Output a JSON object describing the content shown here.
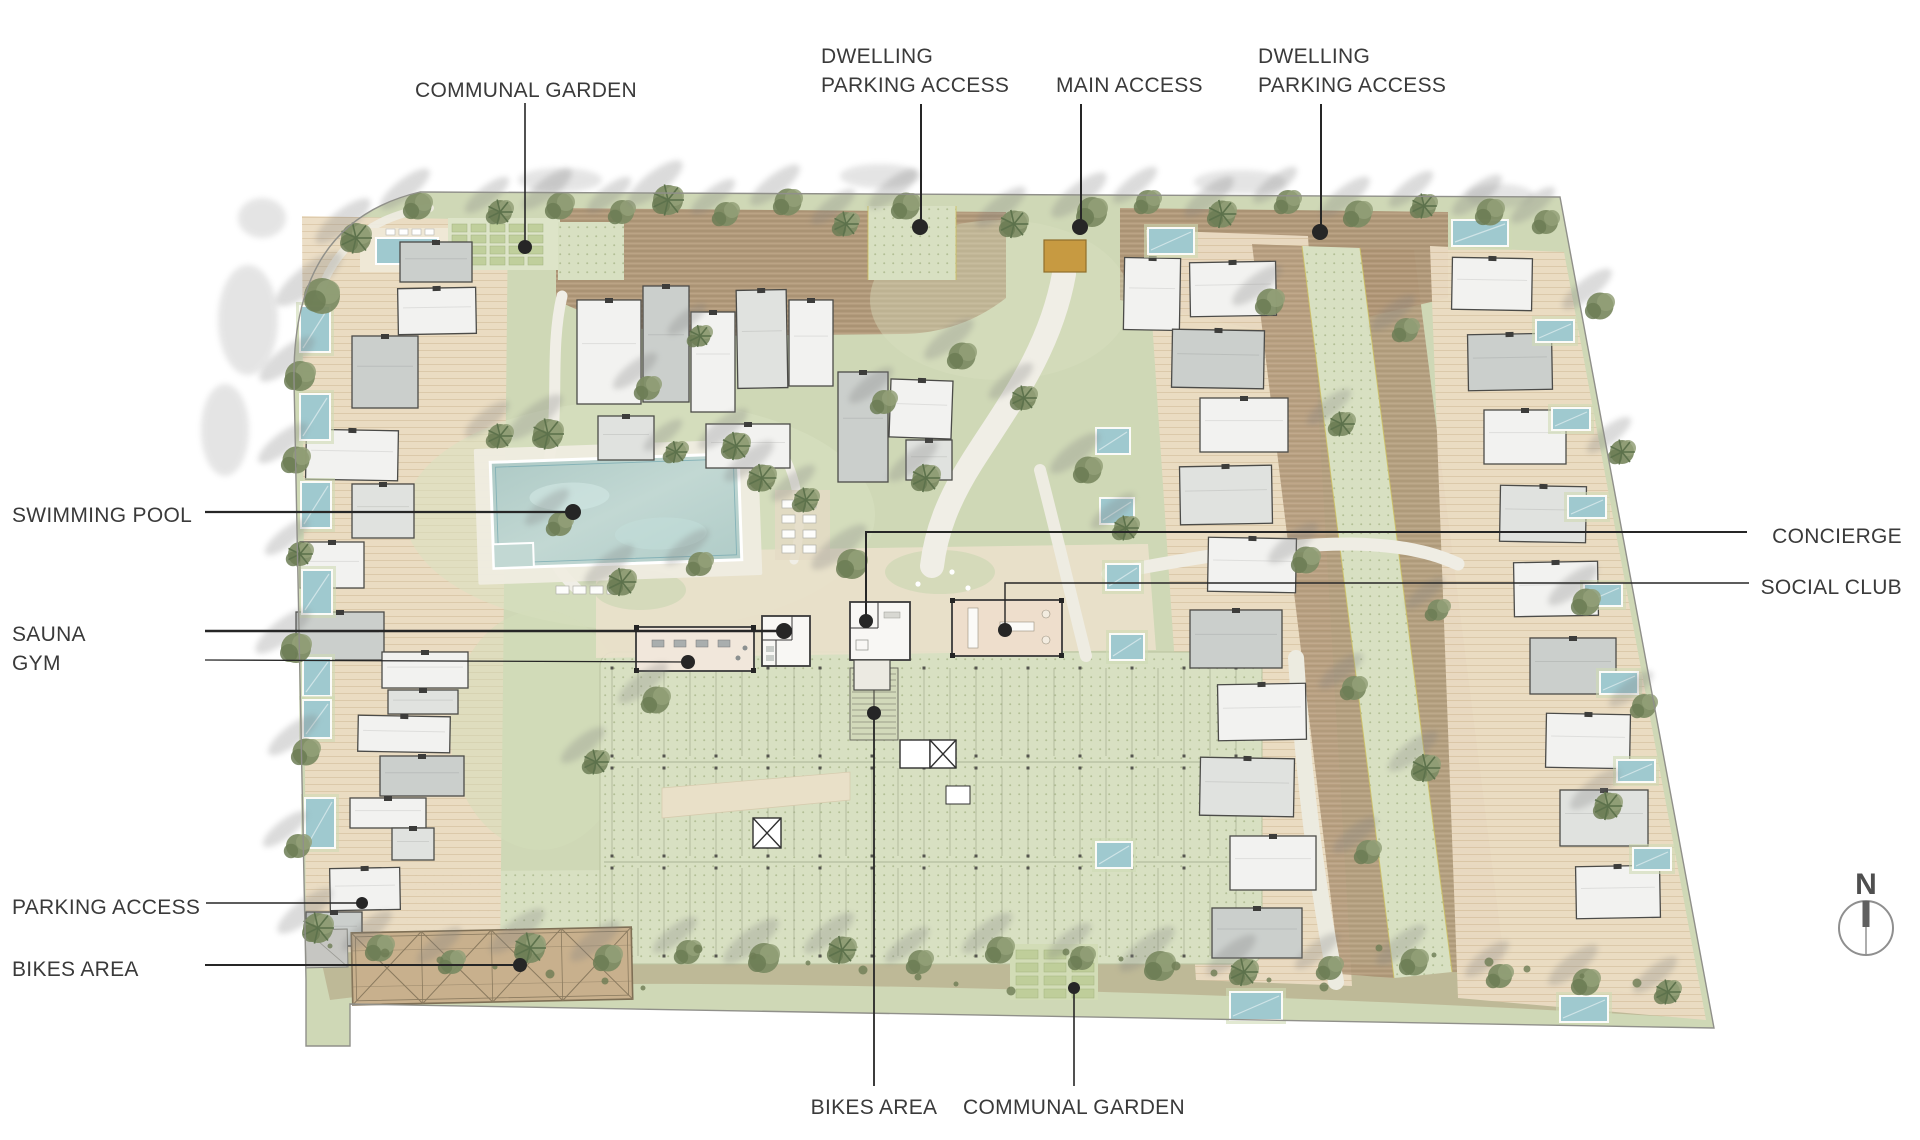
{
  "page": {
    "background": "#ffffff"
  },
  "compass": {
    "letter": "N"
  },
  "palette": {
    "label_ink": "#3a3a3a",
    "leader_ink": "#262626",
    "site_ground": "#cfd8b6",
    "paving_dotted": "#d8e0c2",
    "terrace": "#ebdcc3",
    "deck_brown": "#b2987a",
    "path": "#f0eee6",
    "plaza": "#eae1cb",
    "building_white": "#f2f2f0",
    "building_gray": "#cbcfcc",
    "building_light": "#e0e2df",
    "building_outline": "#4b4b48",
    "amenity_tan": "#eedecc",
    "pool_water": "#b5cfcb",
    "pool_light": "#cde2dd",
    "private_pool": "#9fc9cf",
    "access_gate": "#c79a41",
    "canopy": "#c8b08d",
    "tree": "#7d8c64",
    "tree_shadow": "#808080",
    "boundary": "#90908a"
  },
  "annotations": [
    {
      "name": "communal-garden-top",
      "lines": [
        "COMMUNAL GARDEN"
      ],
      "x": 526,
      "y": 76,
      "align": "center",
      "leader": [
        [
          525,
          103
        ],
        [
          525,
          247
        ]
      ],
      "dot": [
        525,
        247
      ],
      "dot_r": 7,
      "weight": 1.6
    },
    {
      "name": "dwelling-parking-access-west",
      "lines": [
        "DWELLING",
        "PARKING ACCESS"
      ],
      "x": 821,
      "y": 42,
      "align": "left",
      "leader": [
        [
          921,
          104
        ],
        [
          921,
          224
        ]
      ],
      "dot": [
        920,
        227
      ],
      "dot_r": 8,
      "weight": 2
    },
    {
      "name": "main-access",
      "lines": [
        "MAIN ACCESS"
      ],
      "x": 1056,
      "y": 71,
      "align": "left",
      "leader": [
        [
          1081,
          104
        ],
        [
          1081,
          224
        ]
      ],
      "dot": [
        1080,
        227
      ],
      "dot_r": 8,
      "weight": 2
    },
    {
      "name": "dwelling-parking-access-east",
      "lines": [
        "DWELLING",
        "PARKING ACCESS"
      ],
      "x": 1258,
      "y": 42,
      "align": "left",
      "leader": [
        [
          1321,
          104
        ],
        [
          1321,
          229
        ]
      ],
      "dot": [
        1320,
        232
      ],
      "dot_r": 8,
      "weight": 2
    },
    {
      "name": "swimming-pool",
      "lines": [
        "SWIMMING POOL"
      ],
      "x": 12,
      "y": 501,
      "align": "left",
      "leader": [
        [
          205,
          512
        ],
        [
          573,
          512
        ]
      ],
      "dot": [
        573,
        512
      ],
      "dot_r": 8,
      "weight": 2.2
    },
    {
      "name": "sauna",
      "lines": [
        "SAUNA"
      ],
      "x": 12,
      "y": 620,
      "align": "left",
      "leader": [
        [
          205,
          631
        ],
        [
          784,
          631
        ]
      ],
      "dot": [
        784,
        631
      ],
      "dot_r": 8,
      "weight": 2.4
    },
    {
      "name": "gym",
      "lines": [
        "GYM"
      ],
      "x": 12,
      "y": 649,
      "align": "left",
      "leader": [
        [
          205,
          660
        ],
        [
          688,
          662
        ]
      ],
      "dot": [
        688,
        662
      ],
      "dot_r": 7,
      "weight": 1.3
    },
    {
      "name": "concierge",
      "lines": [
        "CONCIERGE"
      ],
      "x": 1902,
      "y": 522,
      "align": "right",
      "leader": [
        [
          1747,
          532
        ],
        [
          866,
          532
        ],
        [
          866,
          621
        ]
      ],
      "dot": [
        866,
        621
      ],
      "dot_r": 7,
      "weight": 2
    },
    {
      "name": "social-club",
      "lines": [
        "SOCIAL CLUB"
      ],
      "x": 1902,
      "y": 573,
      "align": "right",
      "leader": [
        [
          1749,
          583
        ],
        [
          1005,
          583
        ],
        [
          1005,
          630
        ]
      ],
      "dot": [
        1005,
        630
      ],
      "dot_r": 7,
      "weight": 1.4
    },
    {
      "name": "parking-access",
      "lines": [
        "PARKING ACCESS"
      ],
      "x": 12,
      "y": 893,
      "align": "left",
      "leader": [
        [
          206,
          903
        ],
        [
          362,
          903
        ]
      ],
      "dot": [
        362,
        903
      ],
      "dot_r": 6,
      "weight": 1.4
    },
    {
      "name": "bikes-area-west",
      "lines": [
        "BIKES AREA"
      ],
      "x": 12,
      "y": 955,
      "align": "left",
      "leader": [
        [
          205,
          965
        ],
        [
          520,
          965
        ]
      ],
      "dot": [
        520,
        965
      ],
      "dot_r": 7,
      "weight": 2
    },
    {
      "name": "bikes-area-south",
      "lines": [
        "BIKES AREA"
      ],
      "x": 874,
      "y": 1093,
      "align": "center",
      "leader": [
        [
          874,
          1086
        ],
        [
          874,
          716
        ]
      ],
      "dot": [
        874,
        713
      ],
      "dot_r": 7,
      "weight": 1.8
    },
    {
      "name": "communal-garden-south",
      "lines": [
        "COMMUNAL GARDEN"
      ],
      "x": 1074,
      "y": 1093,
      "align": "center",
      "leader": [
        [
          1074,
          1086
        ],
        [
          1074,
          990
        ]
      ],
      "dot": [
        1074,
        988
      ],
      "dot_r": 6,
      "weight": 1.6
    }
  ]
}
